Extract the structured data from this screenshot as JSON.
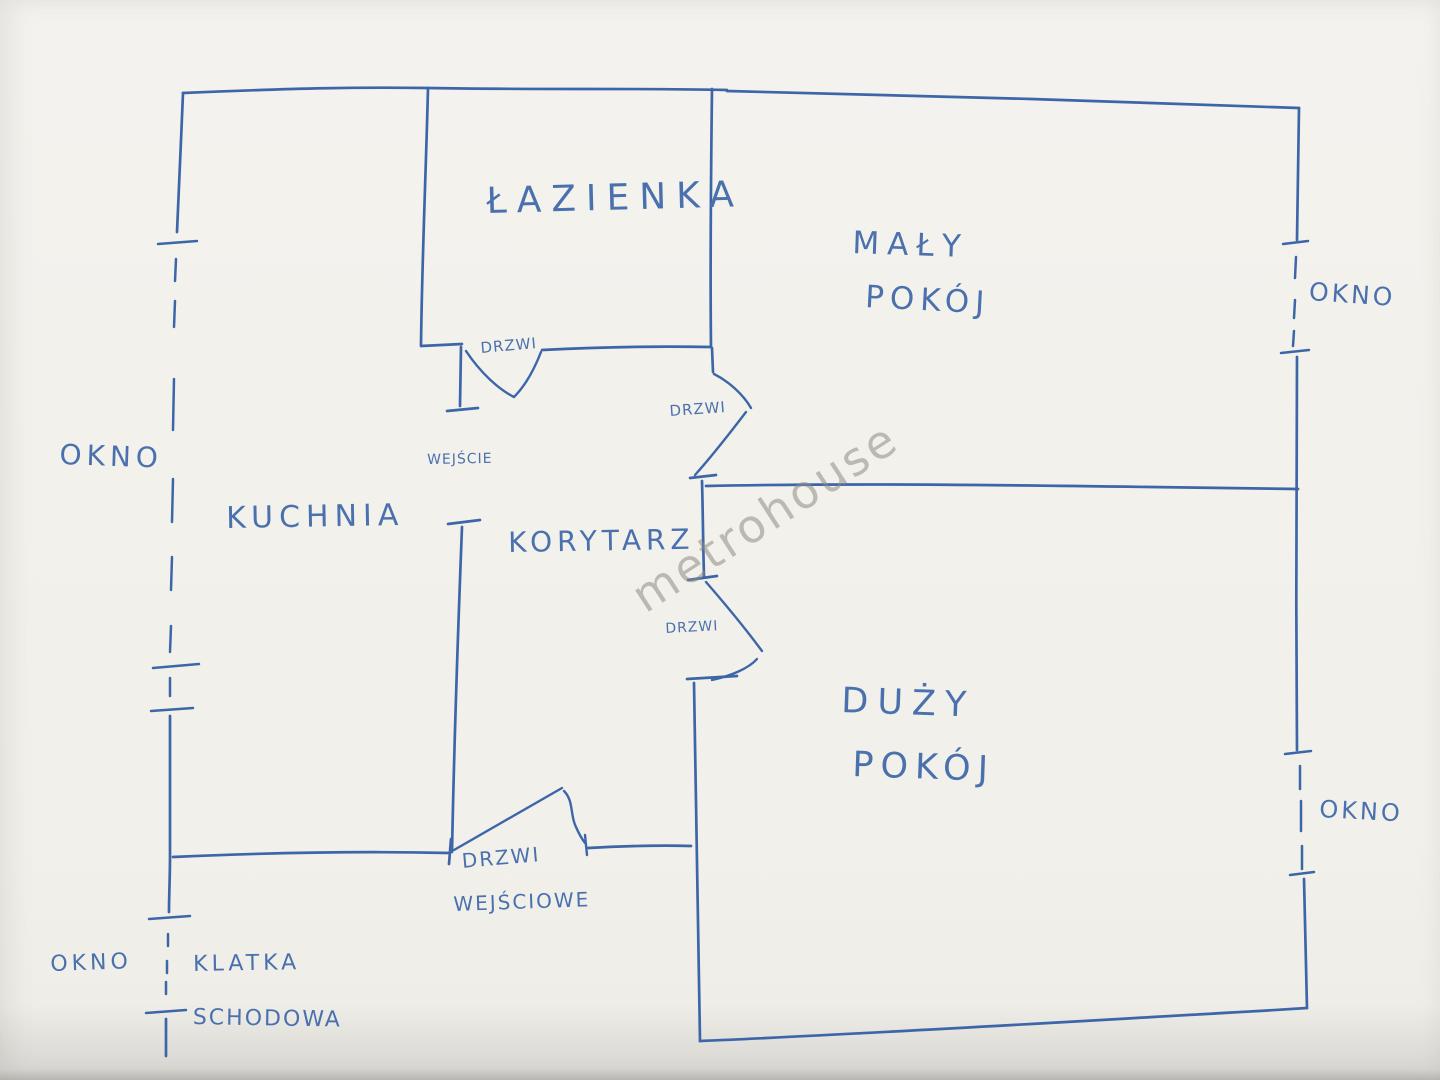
{
  "colors": {
    "ink": "#3d66a8",
    "text_ink": "#4a71ae",
    "paper": "#f2f0ea",
    "watermark": "#8c8a84"
  },
  "rooms": {
    "bathroom": {
      "label": "ŁAZIENKA"
    },
    "small_room": {
      "label_line1": "MAŁY",
      "label_line2": "POKÓJ"
    },
    "kitchen": {
      "label": "KUCHNIA"
    },
    "corridor": {
      "label": "KORYTARZ"
    },
    "large_room": {
      "label_line1": "DUŻY",
      "label_line2": "POKÓJ"
    },
    "staircase": {
      "label_line1": "KLATKA",
      "label_line2": "SCHODOWA"
    }
  },
  "windows": {
    "kitchen_left": {
      "label": "OKNO"
    },
    "small_room_right": {
      "label": "OKNO"
    },
    "large_room_right": {
      "label": "OKNO"
    },
    "staircase_left": {
      "label": "OKNO"
    }
  },
  "doors": {
    "bathroom": {
      "label": "DRZWI"
    },
    "small_room": {
      "label": "DRZWI"
    },
    "large_room": {
      "label": "DRZWI"
    },
    "kitchen_passage": {
      "label": "WEJŚCIE"
    },
    "front_door": {
      "label_line1": "DRZWI",
      "label_line2": "WEJŚCIOWE"
    }
  },
  "watermark": {
    "text": "metrohouse"
  }
}
